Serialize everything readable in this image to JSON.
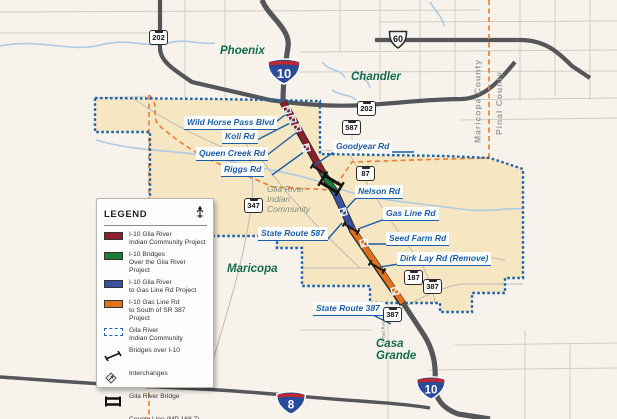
{
  "title": "I-10 Gila River Indian Community corridor map",
  "cities": {
    "phoenix": "Phoenix",
    "chandler": "Chandler",
    "maricopa": "Maricopa",
    "casa_grande": "Casa\nGrande"
  },
  "area_label": "Gila River\nIndian\nCommunity",
  "counties": {
    "maricopa": "Maricopa County",
    "pinal": "Pinal County"
  },
  "streets": {
    "pinal_ave": "Pinal Ave"
  },
  "roads": {
    "wild_horse": "Wild Horse Pass Blvd",
    "koli": "Koli Rd",
    "queen_creek": "Queen Creek Rd",
    "riggs": "Riggs Rd",
    "goodyear": "Goodyear Rd",
    "nelson": "Nelson Rd",
    "gas_line": "Gas Line Rd",
    "seed_farm": "Seed Farm Rd",
    "dirk_lay": "Dirk Lay Rd (Remove)",
    "sr587_label": "State Route 587",
    "sr387_label": "State Route 387"
  },
  "shields": {
    "interstate_10": "10",
    "interstate_8": "8",
    "us_60": "60",
    "sr_202": "202",
    "sr_587": "587",
    "sr_87": "87",
    "sr_347": "347",
    "sr_187": "187",
    "sr_387": "387"
  },
  "legend": {
    "title": "LEGEND",
    "items": [
      {
        "key": "project_red",
        "label": "I-10 Gila River\nIndian Community Project"
      },
      {
        "key": "bridges_green",
        "label": "I-10 Bridges\nOver the Gila River Project"
      },
      {
        "key": "gasline_blue",
        "label": "I-10 Gila River\nto Gas Line Rd Project"
      },
      {
        "key": "south_orange",
        "label": "I-10 Gas Line Rd\nto South of SR 387 Project"
      },
      {
        "key": "community",
        "label": "Gila River\nIndian Community"
      },
      {
        "key": "bridges_over",
        "label": "Bridges over I-10"
      },
      {
        "key": "interchanges",
        "label": "Interchanges"
      },
      {
        "key": "gila_bridge",
        "label": "Gila River Bridge"
      },
      {
        "key": "county_line",
        "label": "County Line (MP 168.7)"
      }
    ]
  },
  "colors": {
    "project_red": "#8E1F2F",
    "bridges_green": "#1F7B39",
    "gasline_blue": "#3C50A2",
    "south_orange": "#E2711D",
    "community_fill": "#F6E7C2",
    "community_border": "#1F64AE",
    "county_line": "#E8813B",
    "label_blue": "#1A5DA8",
    "city_green": "#156B4D",
    "freeway_gray": "#55565A"
  }
}
